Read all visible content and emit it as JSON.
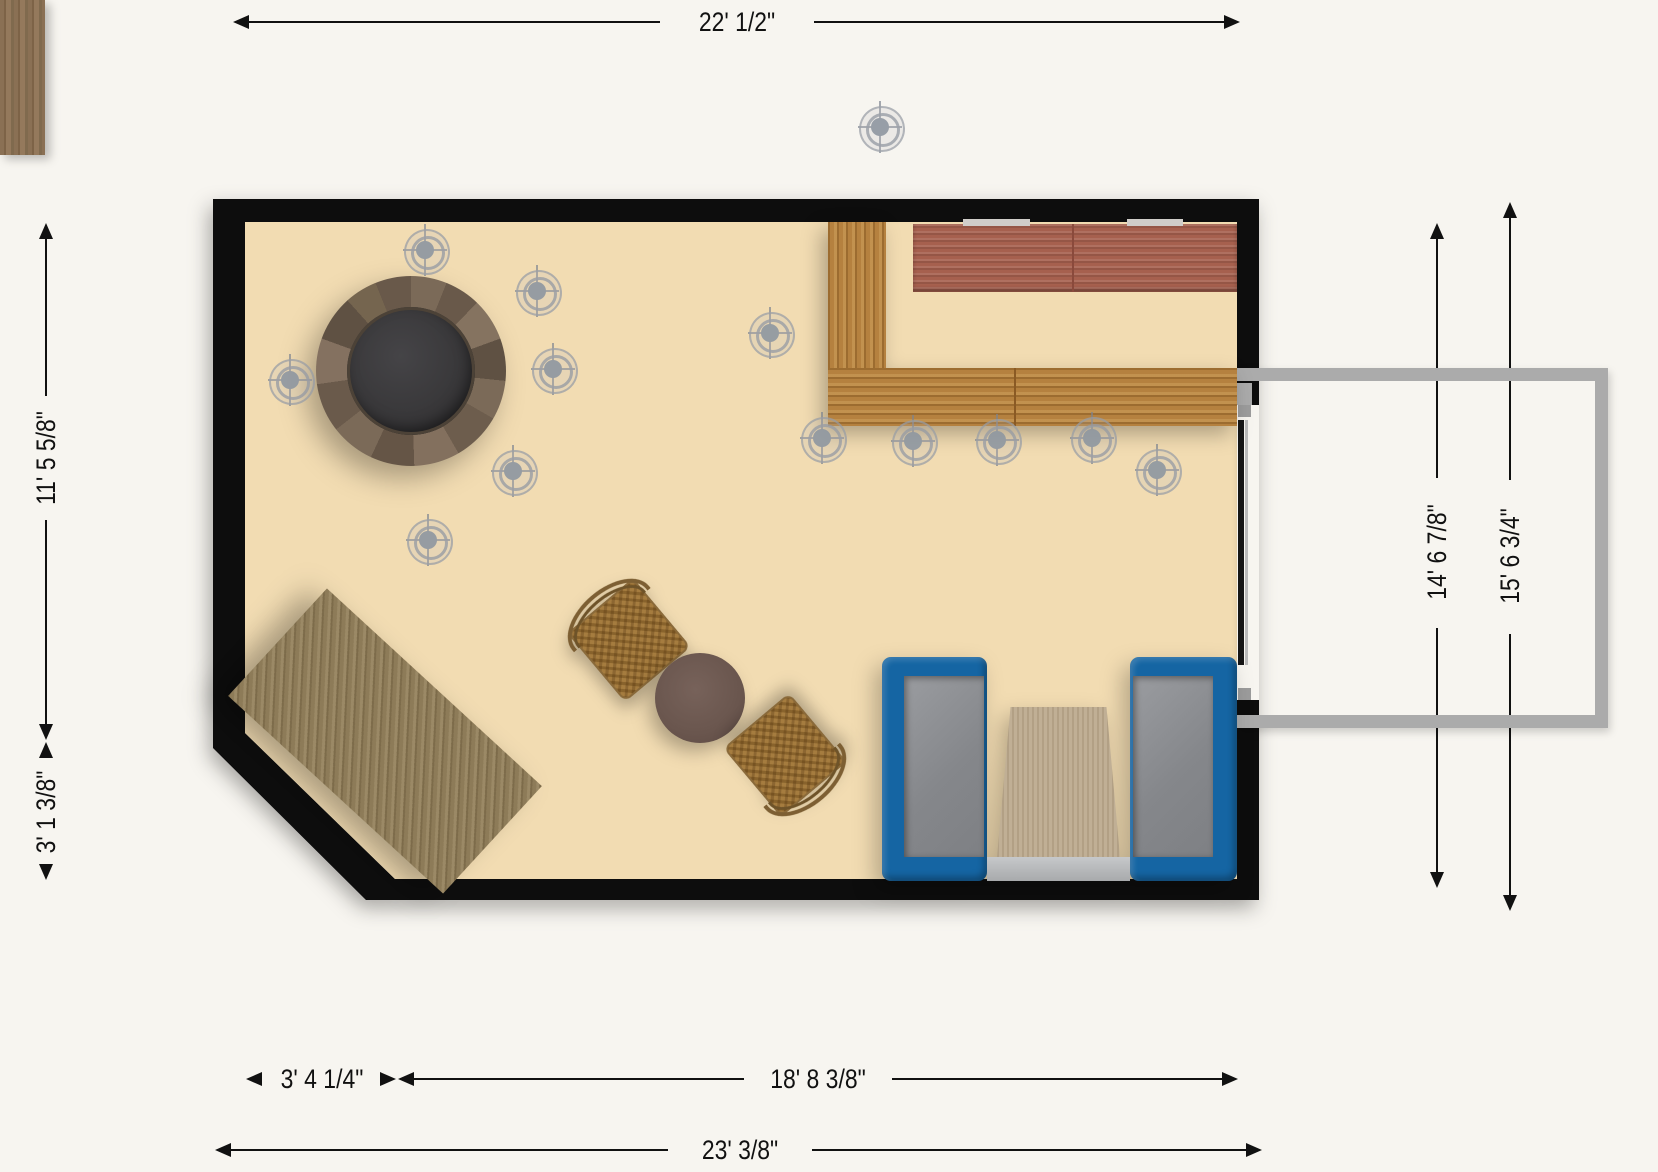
{
  "plan": {
    "dimensions": {
      "top": "22' 1/2\"",
      "left_upper": "11' 5 5/8\"",
      "left_lower": "3' 1 3/8\"",
      "right_inner": "14' 6 7/8\"",
      "right_outer": "15' 6 3/4\"",
      "bottom_small": "3' 4 1/4\"",
      "bottom_large": "18' 8 3/8\"",
      "bottom_total": "23' 3/8\""
    },
    "colors": {
      "floor": "#f2dcb2",
      "wall": "#070707",
      "outside": "#f7f5f0",
      "booth_blue": "#1565a3",
      "bench_gray": "#8f9196",
      "booth_table": "#c0af95",
      "bar_gold": "#b5813f",
      "counter_red": "#a6604e",
      "tub_water": "#3b3a3c",
      "light_gray": "#8f97a1",
      "dim_ink": "#111111",
      "frame_gray": "#ababab",
      "big_table": "#8d7b58",
      "bistro_table": "#6f5a50",
      "wicker": "#a57c3f"
    },
    "lights": [
      {
        "x": 880,
        "y": 127
      },
      {
        "x": 425,
        "y": 250
      },
      {
        "x": 537,
        "y": 291
      },
      {
        "x": 290,
        "y": 380
      },
      {
        "x": 553,
        "y": 369
      },
      {
        "x": 513,
        "y": 471
      },
      {
        "x": 428,
        "y": 540
      },
      {
        "x": 770,
        "y": 333
      },
      {
        "x": 822,
        "y": 438
      },
      {
        "x": 913,
        "y": 441
      },
      {
        "x": 997,
        "y": 440
      },
      {
        "x": 1092,
        "y": 438
      },
      {
        "x": 1157,
        "y": 470
      }
    ],
    "furniture": [
      "hot-tub",
      "bar-back-counter",
      "bar-counter",
      "rotated-wood-table",
      "bistro-table",
      "wicker-chair",
      "wicker-chair",
      "booth-bench",
      "booth-bench",
      "booth-table",
      "sliding-door",
      "patio-frame"
    ]
  }
}
